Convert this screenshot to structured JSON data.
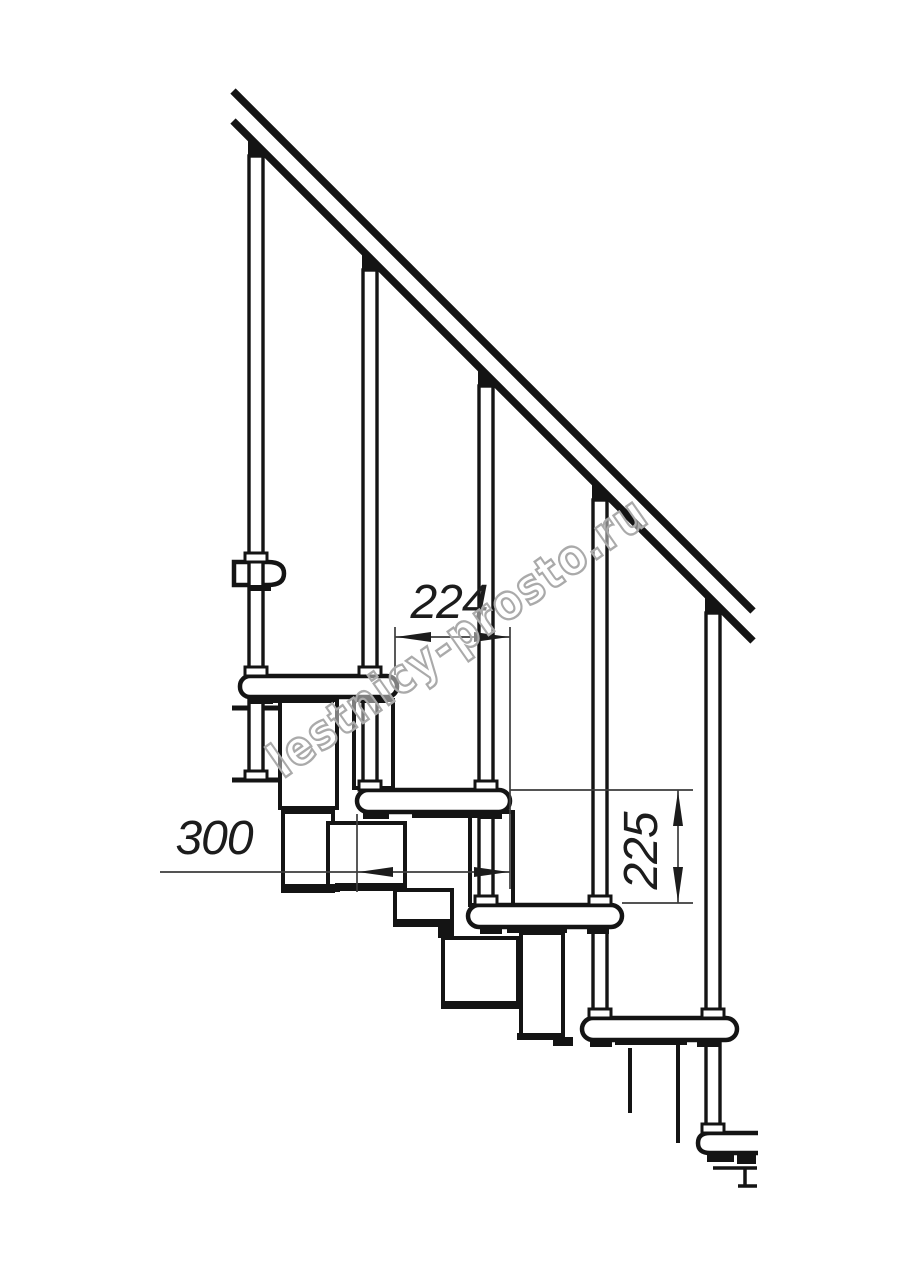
{
  "page": {
    "background": "#ffffff",
    "width": 914,
    "height": 1280
  },
  "drawing": {
    "type": "technical-line-drawing",
    "subject": "modular staircase side elevation fragment",
    "line_color": "#141414",
    "dimension_line_color": "#3c3c3c",
    "fill_color": "#ffffff",
    "balusters_visible": 5,
    "treads_visible": 6
  },
  "dimensions": {
    "step_run": "224",
    "tread_depth": "300",
    "step_rise": "225"
  },
  "watermark": {
    "text": "lestnicy-prosto.ru",
    "outline_color": "#aaaaaa"
  }
}
